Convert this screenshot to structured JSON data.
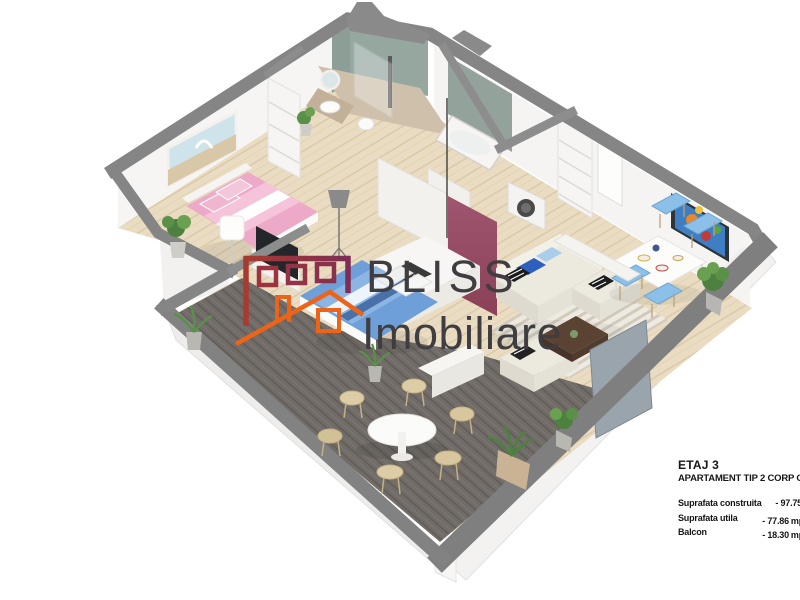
{
  "branding": {
    "logo_primary": "BLISS",
    "logo_secondary": "Imobiliare",
    "logo_icons": [
      "building-outline-icon",
      "house-roof-outline-icon"
    ],
    "logo_colors": {
      "brick_gradient": [
        "#a83a30",
        "#7d2d53"
      ],
      "orange": "#ed6418",
      "text": "#3f3d40"
    }
  },
  "info": {
    "floor_label": "ETAJ 3",
    "apartment_label": "APARTAMENT TIP 2 CORP C",
    "metrics": [
      {
        "label": "Suprafata construita",
        "sep": "-",
        "value": "97.75",
        "unit": ""
      },
      {
        "label": "Suprafata utila",
        "sep": "-",
        "value": "77.86",
        "unit": "mp"
      },
      {
        "label": "Balcon",
        "sep": "-",
        "value": "18.30",
        "unit": "mp"
      }
    ]
  },
  "scene": {
    "type": "isometric-3d-floorplan-render",
    "rooms": [
      "bedroom-pink",
      "bathroom-shower",
      "walk-in-closet",
      "bathroom-tub-washer",
      "kitchen-marsala-island",
      "bedroom-blue",
      "living-room",
      "dining-area",
      "terrace-deck"
    ],
    "palette": {
      "wall_top_gray": "#858585",
      "wall_face_white": "#f5f4f2",
      "wood_floor": "#e9dcc2",
      "deck_dark": "#716c68",
      "tile_green_gray": "#96a7a0",
      "bathroom_floor": "#cfc0ab",
      "kitchen_maroon": "#9c5168",
      "bed_pink": "#eda9c8",
      "bed_blue": "#6f9fd8",
      "pillow_blue": "#2e5fbe",
      "pillow_light_blue": "#a9cdea",
      "sofa_cream": "#eceadf",
      "dining_chair_blue": "#8cc0e8",
      "plant_green": "#4e8040",
      "coffee_table_brown": "#5a4332",
      "tv_panel": "#9aa4ac",
      "info_text": "#161616"
    }
  }
}
